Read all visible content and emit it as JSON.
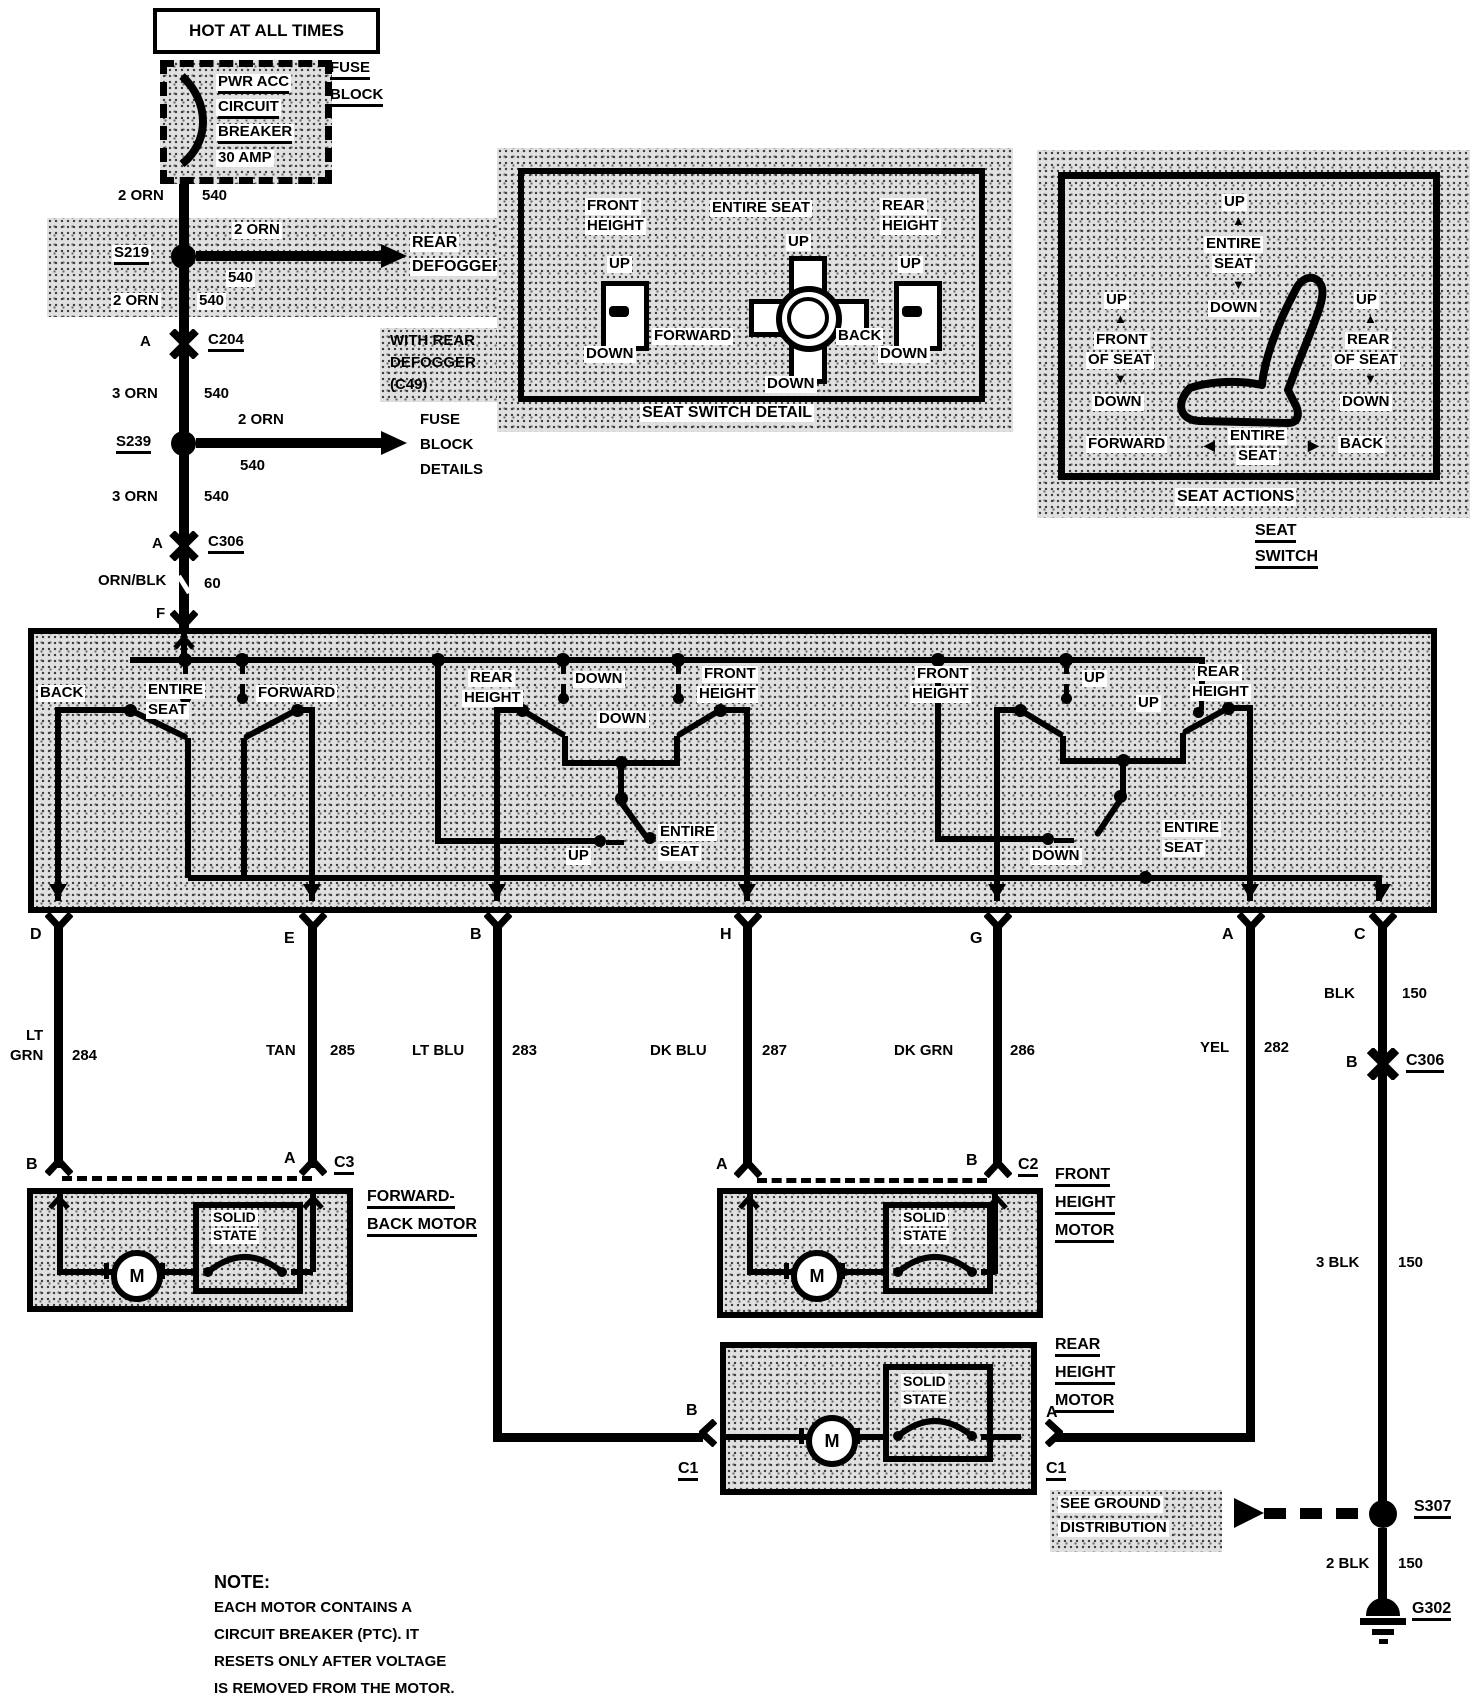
{
  "feed": {
    "hot": "HOT AT ALL TIMES",
    "breaker_lines": [
      "PWR ACC",
      "CIRCUIT",
      "BREAKER",
      "30 AMP"
    ],
    "fuse_block": [
      "FUSE",
      "BLOCK"
    ],
    "seg1": {
      "color": "2 ORN",
      "num": "540"
    },
    "s219": {
      "name": "S219",
      "branch_color": "2 ORN",
      "branch_num": "540",
      "dest1": "REAR",
      "dest2": "DEFOGGER"
    },
    "seg2": {
      "color": "2 ORN",
      "num": "540"
    },
    "c204": {
      "pin": "A",
      "name": "C204"
    },
    "with_defog": [
      "WITH REAR",
      "DEFOGGER",
      "(C49)"
    ],
    "seg3": {
      "color": "3 ORN",
      "num": "540"
    },
    "s239": {
      "name": "S239",
      "branch_color": "2 ORN",
      "branch_num": "540",
      "dest": [
        "FUSE",
        "BLOCK",
        "DETAILS"
      ]
    },
    "seg4": {
      "color": "3 ORN",
      "num": "540"
    },
    "c306": {
      "pin": "A",
      "name": "C306"
    },
    "seg5": {
      "color": "ORN/BLK",
      "num": "60"
    },
    "pin_f": "F"
  },
  "detail": {
    "caption": "SEAT SWITCH DETAIL",
    "front_height": [
      "FRONT",
      "HEIGHT"
    ],
    "fh_up": "UP",
    "fh_down": "DOWN",
    "entire_seat": "ENTIRE SEAT",
    "es_up": "UP",
    "es_forward": "FORWARD",
    "es_back": "BACK",
    "es_down": "DOWN",
    "rear_height": [
      "REAR",
      "HEIGHT"
    ],
    "rh_up": "UP",
    "rh_down": "DOWN"
  },
  "actions": {
    "caption": "SEAT ACTIONS",
    "top": {
      "up": "UP",
      "label": [
        "ENTIRE",
        "SEAT"
      ],
      "down": "DOWN"
    },
    "left": {
      "up": "UP",
      "label": [
        "FRONT",
        "OF SEAT"
      ],
      "down": "DOWN"
    },
    "right": {
      "up": "UP",
      "label": [
        "REAR",
        "OF SEAT"
      ],
      "down": "DOWN"
    },
    "bottom": {
      "forward": "FORWARD",
      "label": [
        "ENTIRE",
        "SEAT"
      ],
      "back": "BACK"
    }
  },
  "icons": {
    "up_arrow": "▲",
    "down_arrow": "▼",
    "left_arrow": "◀",
    "right_arrow": "▶"
  },
  "seat_switch": {
    "title": [
      "SEAT",
      "SWITCH"
    ],
    "back": "BACK",
    "entire_l": [
      "ENTIRE",
      "SEAT"
    ],
    "forward": "FORWARD",
    "rear_height": [
      "REAR",
      "HEIGHT"
    ],
    "down_a": "DOWN",
    "down_b": "DOWN",
    "front_height": [
      "FRONT",
      "HEIGHT"
    ],
    "up_mid": "UP",
    "entire_m": [
      "ENTIRE",
      "SEAT"
    ],
    "front_height_r": [
      "FRONT",
      "HEIGHT"
    ],
    "up_a": "UP",
    "up_b": "UP",
    "rear_height_r": [
      "REAR",
      "HEIGHT"
    ],
    "down_r": "DOWN",
    "entire_r": [
      "ENTIRE",
      "SEAT"
    ]
  },
  "pins": {
    "d": "D",
    "e": "E",
    "b": "B",
    "h": "H",
    "g": "G",
    "a": "A",
    "c": "C"
  },
  "wires": {
    "d": {
      "color1": "LT",
      "color2": "GRN",
      "num": "284"
    },
    "e": {
      "color": "TAN",
      "num": "285"
    },
    "b": {
      "color": "LT BLU",
      "num": "283"
    },
    "h": {
      "color": "DK BLU",
      "num": "287"
    },
    "g": {
      "color": "DK GRN",
      "num": "286"
    },
    "a": {
      "color": "YEL",
      "num": "282"
    },
    "c": {
      "color": "BLK",
      "num": "150"
    }
  },
  "motors": {
    "fwd_back": {
      "label1": "FORWARD-",
      "label2": "BACK MOTOR",
      "pin_left": "B",
      "pin_right": "A",
      "conn": "C3",
      "solid": [
        "SOLID",
        "STATE"
      ],
      "m": "M"
    },
    "front": {
      "label": [
        "FRONT",
        "HEIGHT",
        "MOTOR"
      ],
      "pin_left": "A",
      "pin_right": "B",
      "conn": "C2",
      "solid": [
        "SOLID",
        "STATE"
      ],
      "m": "M"
    },
    "rear": {
      "label": [
        "REAR",
        "HEIGHT",
        "MOTOR"
      ],
      "pin_left": "B",
      "pin_right": "A",
      "conn_left": "C1",
      "conn_right": "C1",
      "solid": [
        "SOLID",
        "STATE"
      ],
      "m": "M"
    }
  },
  "ground": {
    "c306": {
      "pin": "B",
      "name": "C306"
    },
    "blk_a": {
      "color": "BLK",
      "num": "150"
    },
    "blk_b": {
      "color": "3 BLK",
      "num": "150"
    },
    "s307": "S307",
    "see_ground": [
      "SEE GROUND",
      "DISTRIBUTION"
    ],
    "blk_c": {
      "color": "2 BLK",
      "num": "150"
    },
    "g302": "G302"
  },
  "note": {
    "title": "NOTE:",
    "lines": [
      "EACH MOTOR CONTAINS A",
      "CIRCUIT BREAKER (PTC). IT",
      "RESETS ONLY AFTER VOLTAGE",
      "IS REMOVED FROM THE MOTOR."
    ]
  }
}
